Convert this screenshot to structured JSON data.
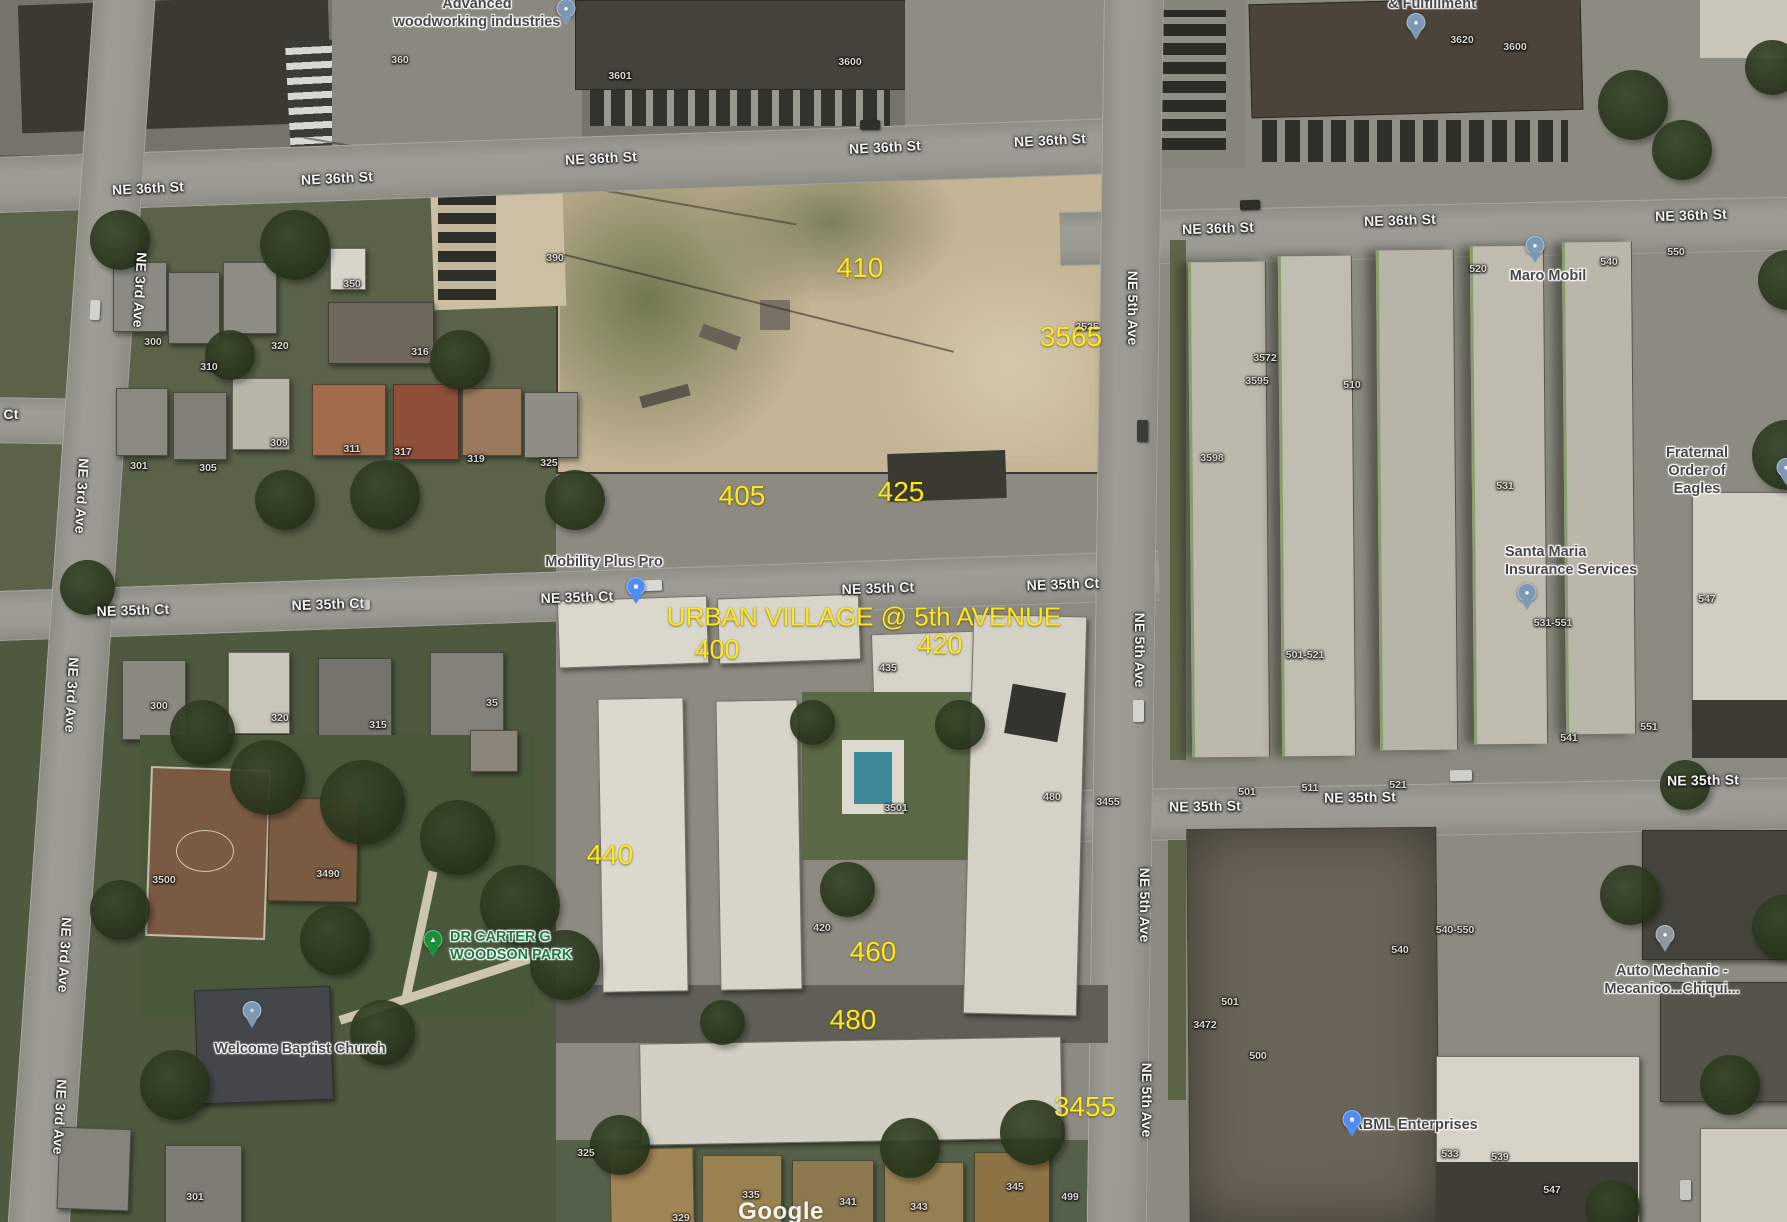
{
  "colors": {
    "annotation": "#ffe81a",
    "street": "#f7f6f2",
    "parcel": "#dcd9d2",
    "poi": "#474747",
    "park": "#167d3f",
    "pin_slate": "#7b99b5",
    "pin_blue": "#4f8df5",
    "pin_green": "#1e8e3e",
    "pin_gray": "#8d979e"
  },
  "map": {
    "attribution": "Google",
    "watermark": {
      "t": "Google",
      "x": 781,
      "y": 1212
    },
    "street_labels": [
      {
        "name": "street-label-ne-36th-st",
        "t": "NE 36th St",
        "x": 148,
        "y": 188,
        "rot": -3
      },
      {
        "name": "street-label-ne-36th-st",
        "t": "NE 36th St",
        "x": 337,
        "y": 178,
        "rot": -3
      },
      {
        "name": "street-label-ne-36th-st",
        "t": "NE 36th St",
        "x": 601,
        "y": 158,
        "rot": -3
      },
      {
        "name": "street-label-ne-36th-st",
        "t": "NE 36th St",
        "x": 885,
        "y": 147,
        "rot": -3
      },
      {
        "name": "street-label-ne-36th-st",
        "t": "NE 36th St",
        "x": 1050,
        "y": 140,
        "rot": -3
      },
      {
        "name": "street-label-ne-36th-st",
        "t": "NE 36th St",
        "x": 1218,
        "y": 228,
        "rot": -2
      },
      {
        "name": "street-label-ne-36th-st",
        "t": "NE 36th St",
        "x": 1400,
        "y": 220,
        "rot": -2
      },
      {
        "name": "street-label-ne-36th-st",
        "t": "NE 36th St",
        "x": 1691,
        "y": 215,
        "rot": -2
      },
      {
        "name": "street-label-ne-35th-ct",
        "t": "NE 35th Ct",
        "x": 133,
        "y": 610,
        "rot": -2
      },
      {
        "name": "street-label-ne-35th-ct",
        "t": "NE 35th Ct",
        "x": 328,
        "y": 604,
        "rot": -2
      },
      {
        "name": "street-label-ne-35th-ct",
        "t": "NE 35th Ct",
        "x": 577,
        "y": 597,
        "rot": -2
      },
      {
        "name": "street-label-ne-35th-ct",
        "t": "NE 35th Ct",
        "x": 878,
        "y": 588,
        "rot": -2
      },
      {
        "name": "street-label-ne-35th-ct",
        "t": "NE 35th Ct",
        "x": 1063,
        "y": 584,
        "rot": -2
      },
      {
        "name": "street-label-ct-partial",
        "t": "Ct",
        "x": 11,
        "y": 414,
        "rot": 0
      },
      {
        "name": "street-label-ne-35th-st",
        "t": "NE 35th St",
        "x": 1205,
        "y": 806,
        "rot": -1
      },
      {
        "name": "street-label-ne-35th-st",
        "t": "NE 35th St",
        "x": 1360,
        "y": 797,
        "rot": -1
      },
      {
        "name": "street-label-ne-35th-st",
        "t": "NE 35th St",
        "x": 1703,
        "y": 780,
        "rot": -1
      },
      {
        "name": "street-label-ne-5th-ave",
        "t": "NE 5th Ave",
        "x": 1133,
        "y": 308,
        "rot": 90
      },
      {
        "name": "street-label-ne-5th-ave",
        "t": "NE 5th Ave",
        "x": 1140,
        "y": 650,
        "rot": 90
      },
      {
        "name": "street-label-ne-5th-ave",
        "t": "NE 5th Ave",
        "x": 1145,
        "y": 905,
        "rot": 90
      },
      {
        "name": "street-label-ne-5th-ave",
        "t": "NE 5th Ave",
        "x": 1147,
        "y": 1100,
        "rot": 90
      },
      {
        "name": "street-label-ne-3rd-ave",
        "t": "NE 3rd Ave",
        "x": 140,
        "y": 290,
        "rot": 93
      },
      {
        "name": "street-label-ne-3rd-ave",
        "t": "NE 3rd Ave",
        "x": 82,
        "y": 496,
        "rot": 93
      },
      {
        "name": "street-label-ne-3rd-ave",
        "t": "NE 3rd Ave",
        "x": 72,
        "y": 695,
        "rot": 93
      },
      {
        "name": "street-label-ne-3rd-ave",
        "t": "NE 3rd Ave",
        "x": 65,
        "y": 955,
        "rot": 93
      },
      {
        "name": "street-label-ne-3rd-ave",
        "t": "NE 3rd Ave",
        "x": 60,
        "y": 1117,
        "rot": 93
      }
    ],
    "parcel_numbers": [
      {
        "t": "360",
        "x": 400,
        "y": 60
      },
      {
        "t": "3601",
        "x": 620,
        "y": 76
      },
      {
        "t": "3600",
        "x": 850,
        "y": 62
      },
      {
        "t": "3620",
        "x": 1462,
        "y": 40
      },
      {
        "t": "3600",
        "x": 1515,
        "y": 47
      },
      {
        "t": "390",
        "x": 555,
        "y": 258
      },
      {
        "t": "350",
        "x": 352,
        "y": 284
      },
      {
        "t": "300",
        "x": 153,
        "y": 342
      },
      {
        "t": "310",
        "x": 209,
        "y": 367
      },
      {
        "t": "320",
        "x": 280,
        "y": 346
      },
      {
        "t": "316",
        "x": 420,
        "y": 352
      },
      {
        "t": "301",
        "x": 139,
        "y": 466
      },
      {
        "t": "305",
        "x": 208,
        "y": 468
      },
      {
        "t": "309",
        "x": 279,
        "y": 443
      },
      {
        "t": "311",
        "x": 352,
        "y": 449
      },
      {
        "t": "317",
        "x": 403,
        "y": 452
      },
      {
        "t": "319",
        "x": 476,
        "y": 459
      },
      {
        "t": "325",
        "x": 549,
        "y": 463
      },
      {
        "t": "3525",
        "x": 1087,
        "y": 327
      },
      {
        "t": "3572",
        "x": 1265,
        "y": 358
      },
      {
        "t": "3595",
        "x": 1257,
        "y": 381
      },
      {
        "t": "3598",
        "x": 1212,
        "y": 458
      },
      {
        "t": "510",
        "x": 1352,
        "y": 385
      },
      {
        "t": "520",
        "x": 1478,
        "y": 269
      },
      {
        "t": "540",
        "x": 1609,
        "y": 262
      },
      {
        "t": "550",
        "x": 1676,
        "y": 252
      },
      {
        "t": "531",
        "x": 1505,
        "y": 486
      },
      {
        "t": "501-521",
        "x": 1305,
        "y": 655
      },
      {
        "t": "531-551",
        "x": 1553,
        "y": 623
      },
      {
        "t": "547",
        "x": 1707,
        "y": 599
      },
      {
        "t": "501",
        "x": 1247,
        "y": 792
      },
      {
        "t": "511",
        "x": 1310,
        "y": 788
      },
      {
        "t": "521",
        "x": 1398,
        "y": 785
      },
      {
        "t": "541",
        "x": 1569,
        "y": 738
      },
      {
        "t": "551",
        "x": 1649,
        "y": 727
      },
      {
        "t": "435",
        "x": 888,
        "y": 668
      },
      {
        "t": "3501",
        "x": 896,
        "y": 808
      },
      {
        "t": "420",
        "x": 822,
        "y": 928
      },
      {
        "t": "480",
        "x": 1052,
        "y": 797
      },
      {
        "t": "3455",
        "x": 1108,
        "y": 802
      },
      {
        "t": "300",
        "x": 159,
        "y": 706
      },
      {
        "t": "320",
        "x": 280,
        "y": 718
      },
      {
        "t": "315",
        "x": 378,
        "y": 725
      },
      {
        "t": "35",
        "x": 492,
        "y": 703
      },
      {
        "t": "3500",
        "x": 164,
        "y": 880
      },
      {
        "t": "3490",
        "x": 328,
        "y": 874
      },
      {
        "t": "540-550",
        "x": 1455,
        "y": 930
      },
      {
        "t": "540",
        "x": 1400,
        "y": 950
      },
      {
        "t": "501",
        "x": 1230,
        "y": 1002
      },
      {
        "t": "3472",
        "x": 1205,
        "y": 1025
      },
      {
        "t": "500",
        "x": 1258,
        "y": 1056
      },
      {
        "t": "533",
        "x": 1450,
        "y": 1154
      },
      {
        "t": "539",
        "x": 1500,
        "y": 1157
      },
      {
        "t": "547",
        "x": 1552,
        "y": 1190
      },
      {
        "t": "499",
        "x": 1070,
        "y": 1197
      },
      {
        "t": "345",
        "x": 1015,
        "y": 1187
      },
      {
        "t": "343",
        "x": 919,
        "y": 1207
      },
      {
        "t": "341",
        "x": 848,
        "y": 1202
      },
      {
        "t": "335",
        "x": 751,
        "y": 1195
      },
      {
        "t": "329",
        "x": 681,
        "y": 1218
      },
      {
        "t": "325",
        "x": 586,
        "y": 1153
      },
      {
        "t": "301",
        "x": 195,
        "y": 1197
      }
    ],
    "pois": [
      {
        "name": "advanced-woodworking-label",
        "t": "Advanced\nwoodworking industries",
        "x": 477,
        "y": 13
      },
      {
        "name": "fulfillment-label",
        "t": "& Fulfillment",
        "x": 1432,
        "y": 4
      },
      {
        "name": "maro-mobil-label",
        "t": "Maro Mobil",
        "x": 1548,
        "y": 276
      },
      {
        "name": "mobility-plus-pro-label",
        "t": "Mobility Plus Pro",
        "x": 604,
        "y": 562
      },
      {
        "name": "fraternal-order-of-eagles-label",
        "t": "Fraternal Order of Eagles",
        "x": 1697,
        "y": 471
      },
      {
        "name": "santa-maria-insurance-label",
        "t": "Santa Maria\nInsurance Services",
        "x": 1505,
        "y": 543,
        "align": "left",
        "cls": "left"
      },
      {
        "name": "auto-mechanic-label",
        "t": "Auto Mechanic -\nMecanico...Chiqui...",
        "x": 1672,
        "y": 980
      },
      {
        "name": "abml-enterprises-label",
        "t": "ABML Enterprises",
        "x": 1415,
        "y": 1125
      },
      {
        "name": "welcome-baptist-church-label",
        "t": "Welcome Baptist Church",
        "x": 300,
        "y": 1049
      },
      {
        "name": "woodson-park-label",
        "t": "DR CARTER G\nWOODSON PARK",
        "x": 450,
        "y": 928,
        "align": "left",
        "cls": "park"
      }
    ],
    "pins": [
      {
        "name": "advanced-woodworking-pin",
        "x": 566,
        "y": 26,
        "cls": "slate",
        "glyph": "●",
        "align": "pin"
      },
      {
        "name": "fulfillment-pin",
        "x": 1416,
        "y": 40,
        "cls": "slate",
        "glyph": "●",
        "align": "pin"
      },
      {
        "name": "maro-mobil-pin",
        "x": 1535,
        "y": 263,
        "cls": "slate",
        "glyph": "●",
        "align": "pin"
      },
      {
        "name": "mobility-plus-pro-pin",
        "x": 636,
        "y": 604,
        "cls": "blue",
        "glyph": "■",
        "align": "pin"
      },
      {
        "name": "fraternal-order-of-eagles-pin",
        "x": 1786,
        "y": 485,
        "cls": "slate",
        "glyph": "●",
        "align": "pin"
      },
      {
        "name": "santa-maria-insurance-pin",
        "x": 1527,
        "y": 610,
        "cls": "slate",
        "glyph": "●",
        "align": "pin"
      },
      {
        "name": "auto-mechanic-pin",
        "x": 1665,
        "y": 952,
        "cls": "gray",
        "glyph": "●",
        "align": "pin"
      },
      {
        "name": "abml-enterprises-pin",
        "x": 1352,
        "y": 1137,
        "cls": "blue",
        "glyph": "■",
        "align": "pin"
      },
      {
        "name": "welcome-baptist-church-pin",
        "x": 252,
        "y": 1028,
        "cls": "slate",
        "glyph": "+",
        "align": "pin"
      },
      {
        "name": "woodson-park-pin",
        "x": 433,
        "y": 957,
        "cls": "green",
        "glyph": "▲",
        "align": "pin"
      }
    ],
    "annotations": [
      {
        "name": "annotation-410",
        "t": "410",
        "x": 860,
        "y": 268,
        "size": 28
      },
      {
        "name": "annotation-3565",
        "t": "3565",
        "x": 1071,
        "y": 337,
        "size": 28
      },
      {
        "name": "annotation-405",
        "t": "405",
        "x": 742,
        "y": 496,
        "size": 28
      },
      {
        "name": "annotation-425",
        "t": "425",
        "x": 901,
        "y": 492,
        "size": 28
      },
      {
        "name": "annotation-urban-village",
        "t": "URBAN VILLAGE @ 5th AVENUE",
        "x": 864,
        "y": 617,
        "size": 26
      },
      {
        "name": "annotation-400",
        "t": "400",
        "x": 717,
        "y": 650,
        "size": 27
      },
      {
        "name": "annotation-420",
        "t": "420",
        "x": 940,
        "y": 645,
        "size": 27
      },
      {
        "name": "annotation-440",
        "t": "440",
        "x": 610,
        "y": 855,
        "size": 28
      },
      {
        "name": "annotation-460",
        "t": "460",
        "x": 873,
        "y": 952,
        "size": 28
      },
      {
        "name": "annotation-480",
        "t": "480",
        "x": 853,
        "y": 1020,
        "size": 28
      },
      {
        "name": "annotation-3455",
        "t": "3455",
        "x": 1085,
        "y": 1107,
        "size": 28
      }
    ]
  }
}
